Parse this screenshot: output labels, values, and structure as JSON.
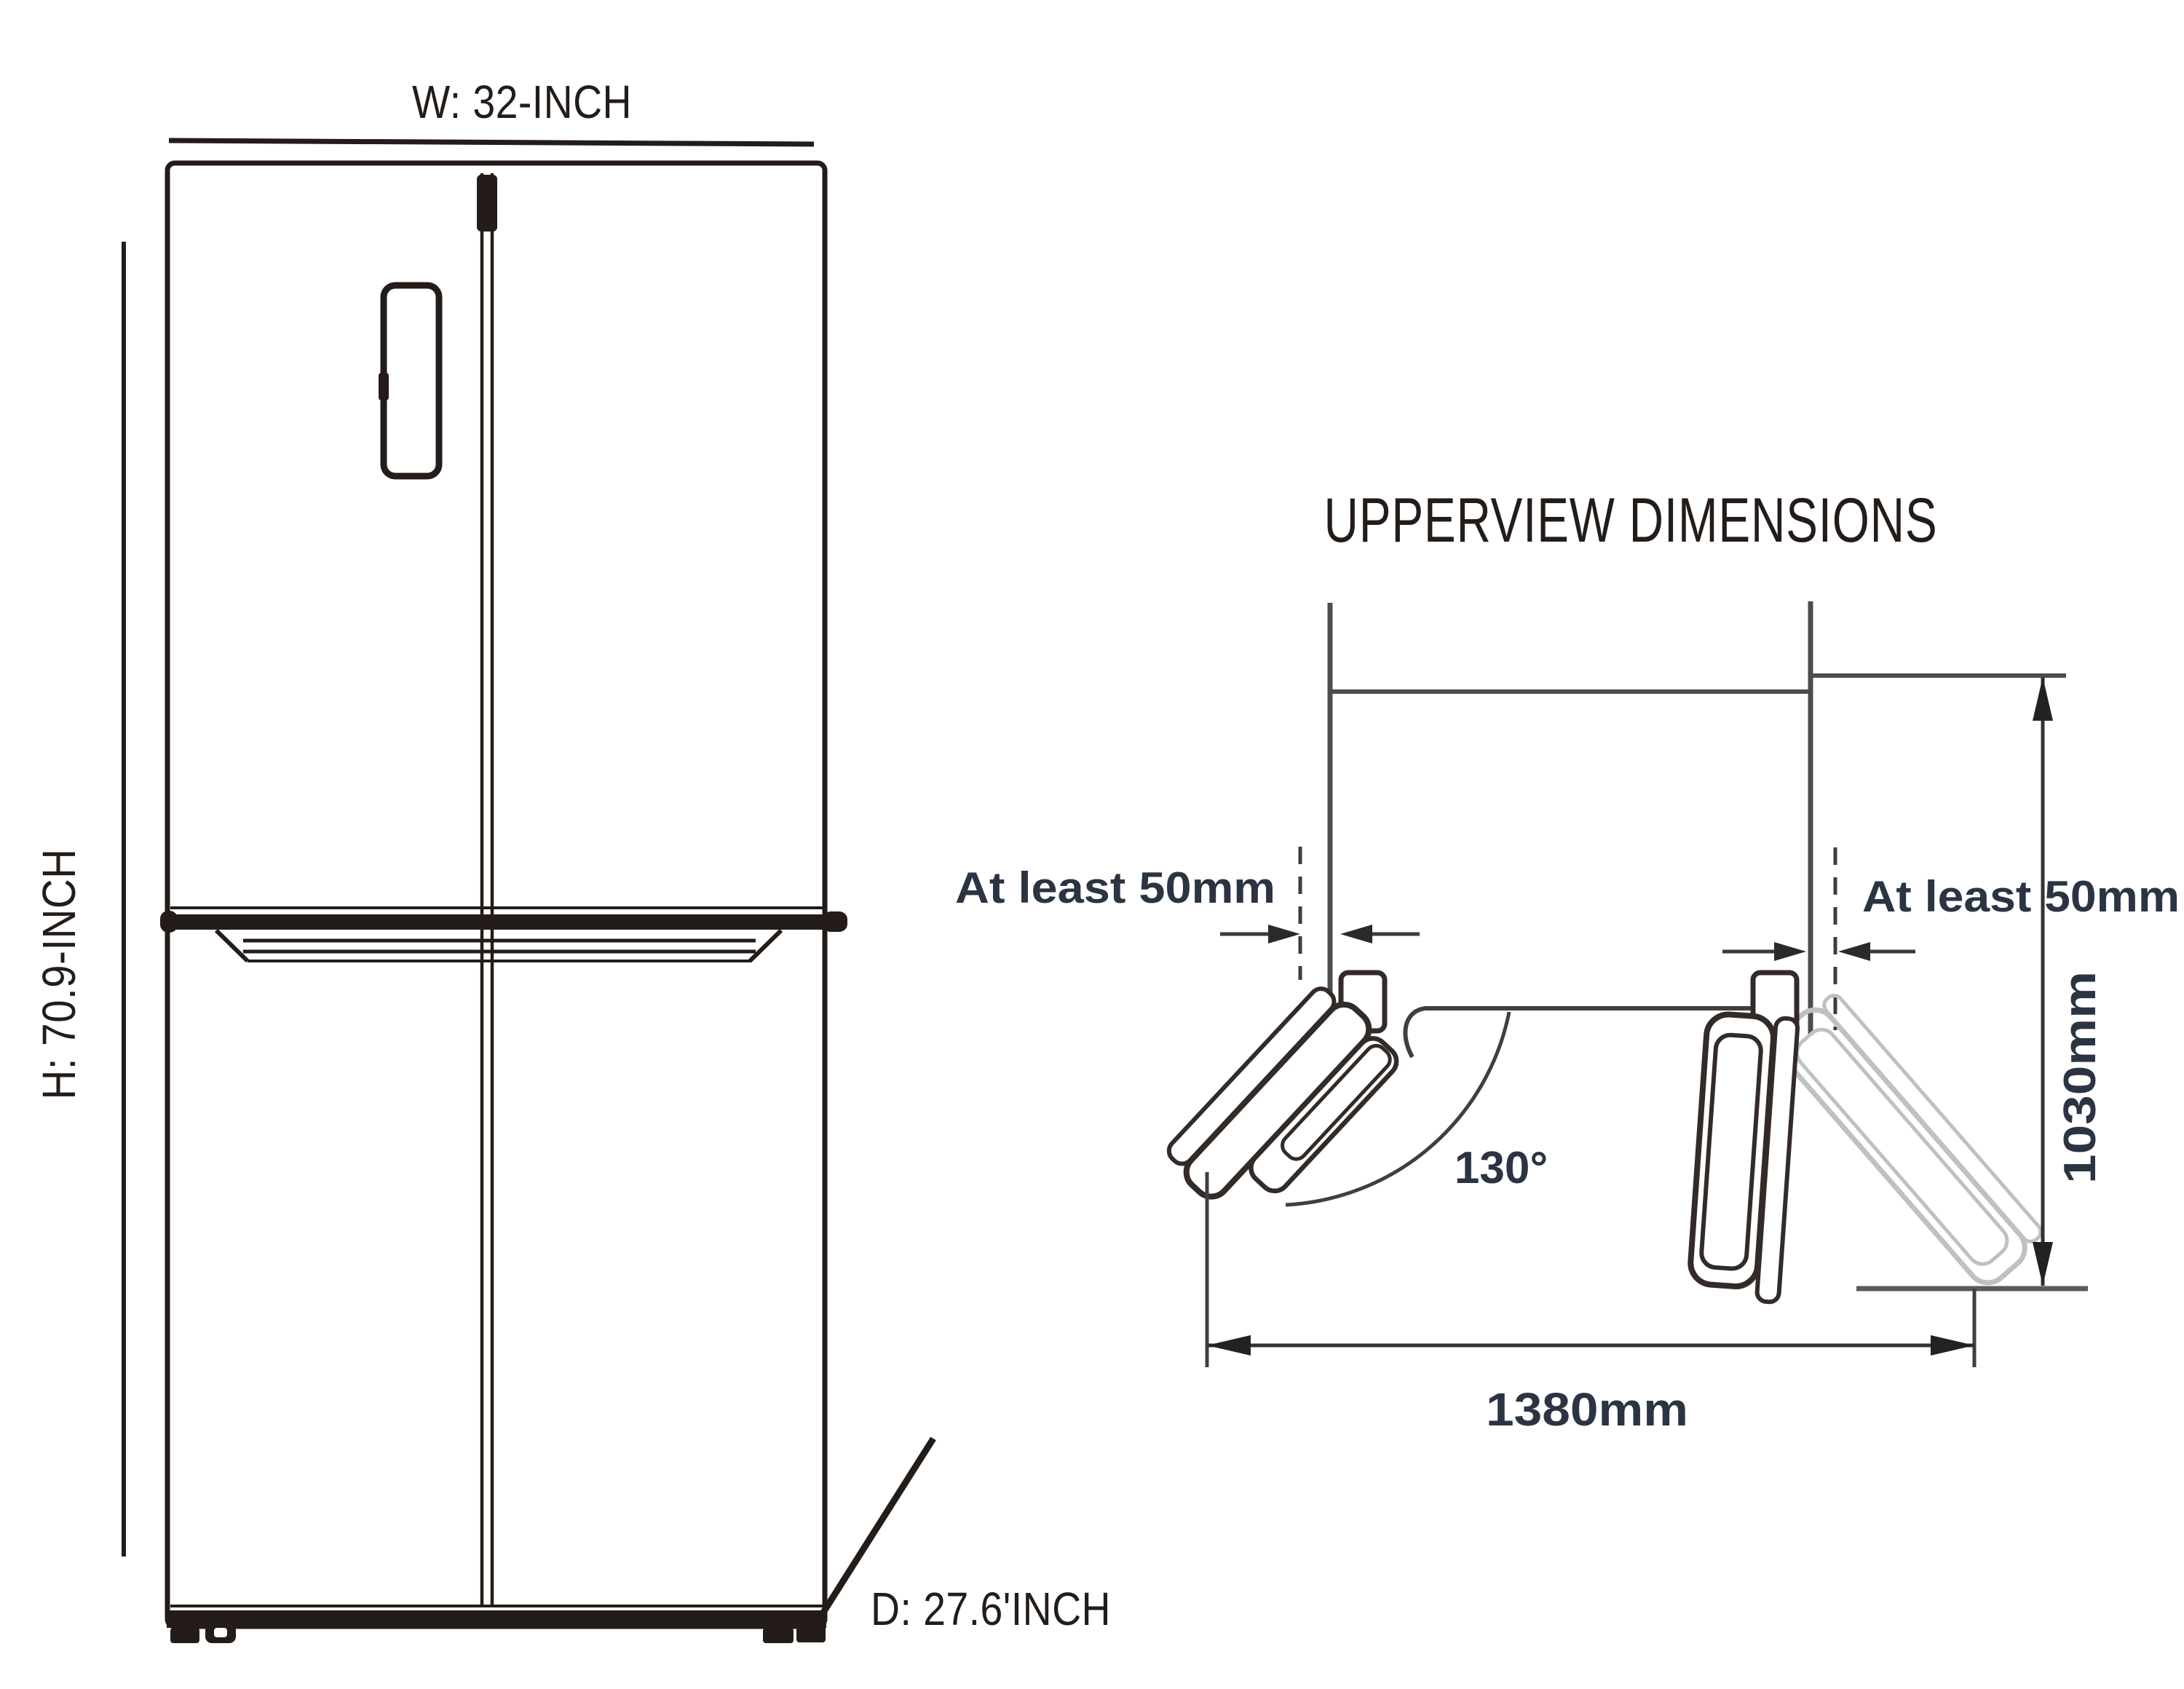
{
  "front_view": {
    "width_label": "W: 32-INCH",
    "height_label": "H: 70.9-INCH",
    "depth_label": "D: 27.6'INCH"
  },
  "top_view": {
    "title": "UPPERVIEW DIMENSIONS",
    "left_clearance": "At least 50mm",
    "right_clearance": "At least 50mm",
    "swing_angle": "130°",
    "depth_dim": "1030mm",
    "width_dim": "1380mm"
  },
  "colors": {
    "ink": "#241c18",
    "wall_gray": "#4d4d4d",
    "dim_dark": "#333333",
    "accent_text": "#2b3442",
    "ghost": "#c0c0c0"
  }
}
